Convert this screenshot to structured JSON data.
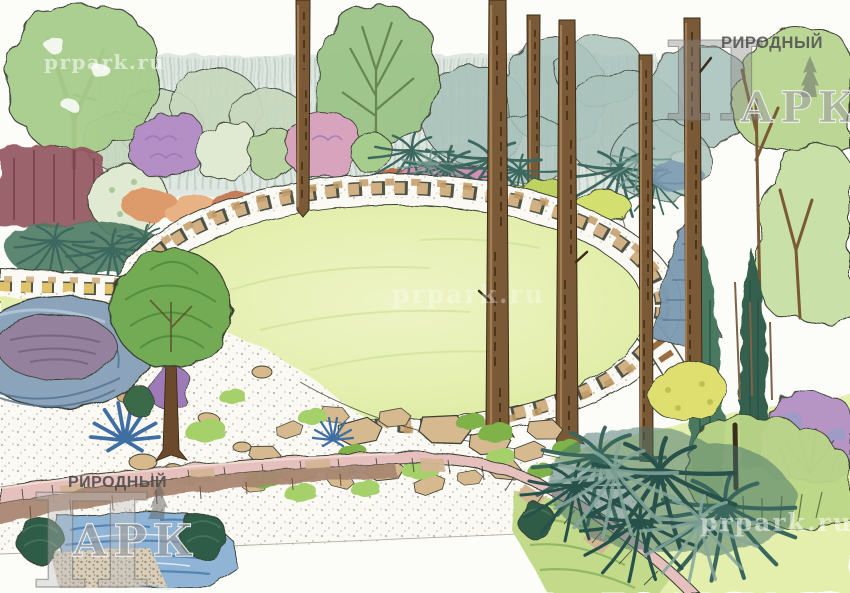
{
  "watermarks": {
    "url_text": "prpark.ru",
    "brand_initial": "П",
    "brand_word_remainder": "РИРОДНЫЙ",
    "brand_word_bottom": "АРК"
  },
  "colors": {
    "paper": "#fcfcf8",
    "ink": "#3a4034",
    "lawn": "#e4efae",
    "lawn_light": "#eef4c6",
    "lawn_edge": "#cfe195",
    "lawn_line": "#a9bd78",
    "gravel": "#faf9f3",
    "stipple": "#a2947c",
    "band_stone": "#d1b083",
    "band_stone2": "#c19b66",
    "yellow_stone": "#dfc269",
    "hedge_dark": "#7d9a7f",
    "canopy_blue": "#aac3bc",
    "canopy_sage": "#c6d8bd",
    "tree_green": "#a7cd8c",
    "tree_dark": "#7fae68",
    "poplar": "#9dc489",
    "branch_green": "#5d7a48",
    "maroon": "#93575e",
    "maroon_dark": "#77414a",
    "purple": "#b48fc6",
    "purple_dark": "#9a75b5",
    "white_shrub": "#e0ead3",
    "pink_shrub": "#d8a3bd",
    "pink_flower": "#d68fb4",
    "pink_dark": "#b66d99",
    "orange": "#dd9a6a",
    "orange_light": "#e9b284",
    "orange_deep": "#c2714b",
    "fern": "#3c685f",
    "fern_light": "#6f958a",
    "yellow_green": "#cada6d",
    "yellow_shrub": "#dfdf70",
    "stem_dark": "#55663a",
    "spruce": "#7c99b2",
    "spruce_dark": "#5d7f99",
    "conifer": "#4a7a5f",
    "conifer_dark": "#35614d",
    "grass_dark": "#27514a",
    "grass_mid": "#3a675d",
    "grass_light": "#85a79c",
    "topiary": "#72ab53",
    "topiary_stroke": "#4c8a3c",
    "ball_green": "#2d5c46",
    "ball_light": "#47755d",
    "trunk": "#7a5936",
    "trunk_dark": "#4c3519",
    "trunk_light": "#a8845a",
    "pond_stone": "#8ba4bb",
    "pond_stone_dark": "#55718f",
    "pond_water": "#94819d",
    "pond_water_dark": "#75617f",
    "wall_pink": "#e5c0bd",
    "wall_tan": "#d3b493",
    "wall_face": "#a98873",
    "water": "#8fb4d6",
    "water_dark": "#4d7cab",
    "moss": "#a5d06a",
    "moss_dark": "#7fb34a",
    "mound": "#c2da8a",
    "mound_dark": "#8bb25e",
    "logo_gray": "#8a8a8a",
    "logo_dark": "#4d4d4d",
    "wm_white": "#ffffff"
  }
}
